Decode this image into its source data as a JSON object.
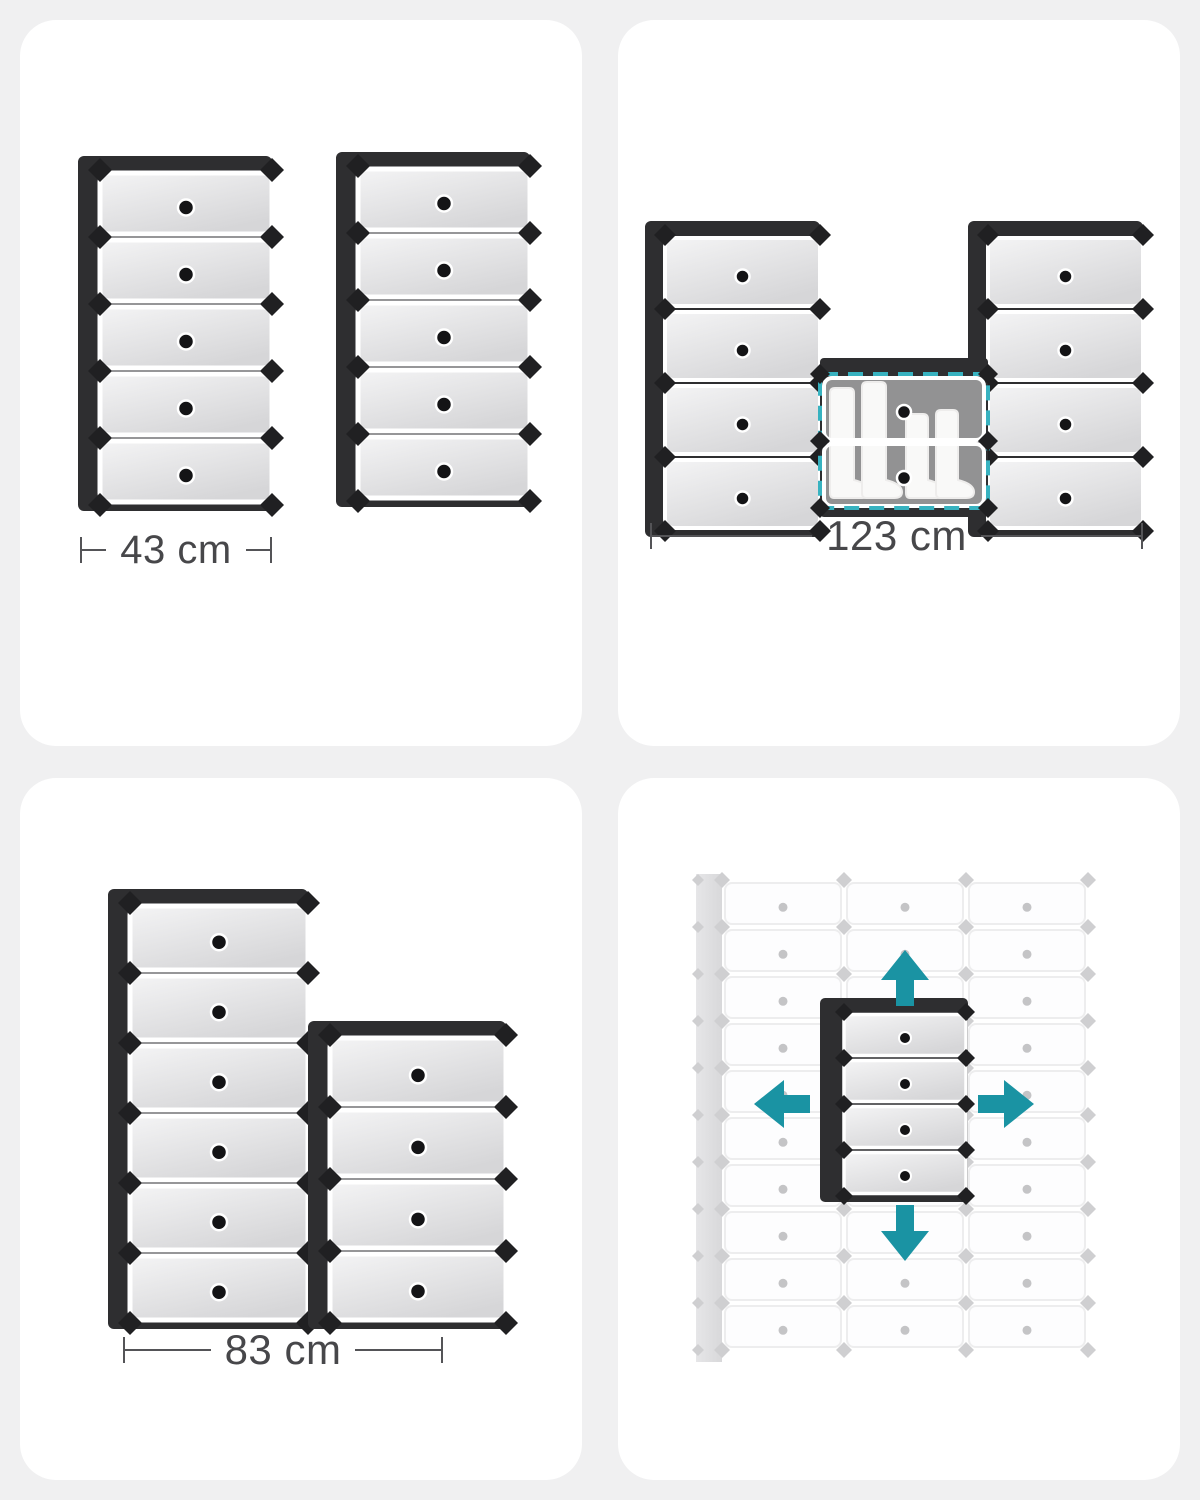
{
  "page": {
    "background": "#f0f0f1",
    "panel_background": "#ffffff"
  },
  "colors": {
    "rack_dark": "#2e2e30",
    "connector_dark": "#202022",
    "tier_light": "#f4f4f5",
    "tier_shade": "#d6d6d8",
    "knob_dark": "#141416",
    "dimension_text": "#47474a",
    "teal_arrow": "#1a93a3",
    "teal_dashed": "#37b2c0",
    "faded_cell_edge": "#ededee",
    "faded_connector": "#cfcfd1",
    "faded_knob": "#c4c4c6",
    "faded_side": "#d8d8da",
    "boot_fill": "#f4f3f1",
    "boot_edge": "#dfddda"
  },
  "panels": {
    "dual_towers": {
      "title": "two 5-tier shoe rack towers",
      "dimension_label": "43 cm",
      "towers": [
        {
          "tiers": 5
        },
        {
          "tiers": 5
        }
      ]
    },
    "u_config": {
      "title": "combined U-shaped configuration",
      "dimension_label": "123 cm",
      "left_tower_tiers": 4,
      "middle_compartment_tiers": 2,
      "right_tower_tiers": 4,
      "middle_contents": "boots"
    },
    "step_config": {
      "title": "stepped configuration",
      "dimension_label": "83 cm",
      "towers": [
        {
          "tiers": 6
        },
        {
          "tiers": 4
        }
      ]
    },
    "expand_grid": {
      "title": "expandable modular grid",
      "grid_columns": 3,
      "grid_rows": 10,
      "unit_tiers": 4,
      "arrow_directions": [
        "up",
        "left",
        "right",
        "down"
      ]
    }
  }
}
